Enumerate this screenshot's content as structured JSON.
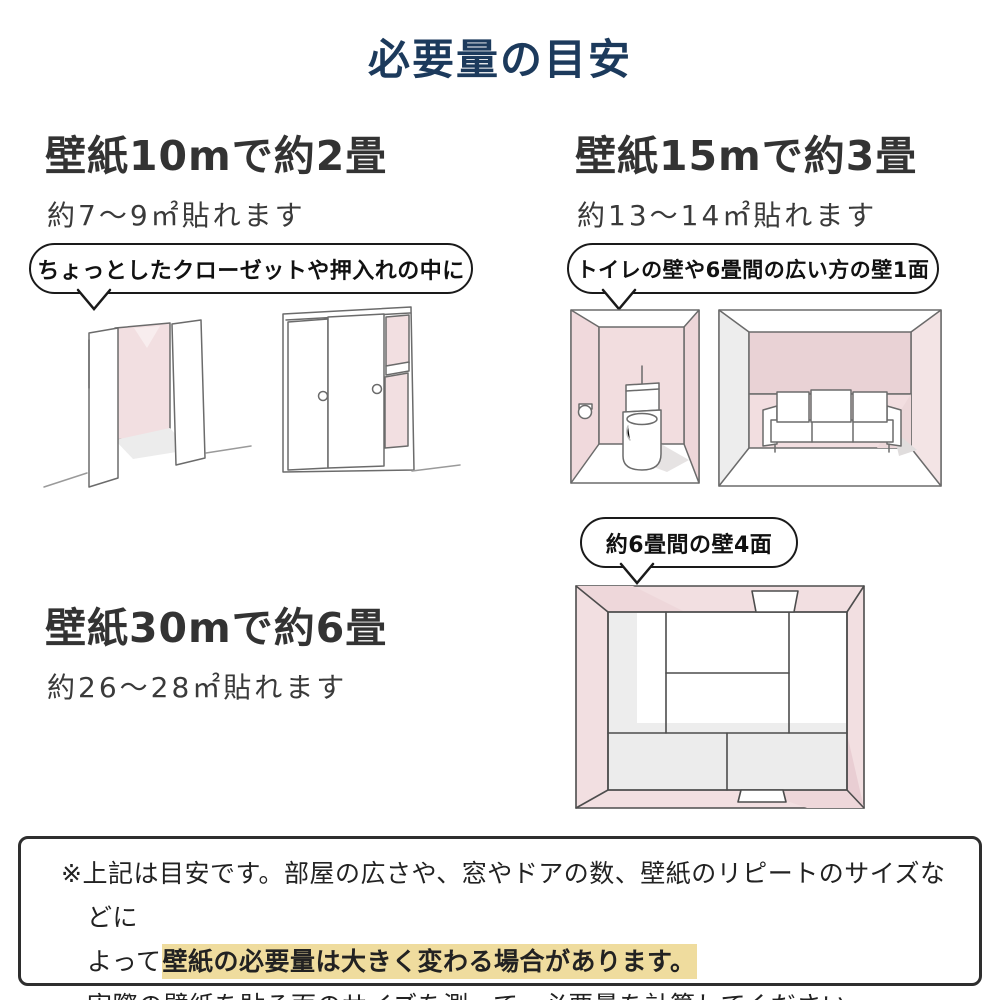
{
  "page": {
    "title": "必要量の目安"
  },
  "sections": [
    {
      "heading": "壁紙10mで約2畳",
      "subtext": "約7〜9㎡貼れます",
      "bubble": "ちょっとしたクローゼットや押入れの中に"
    },
    {
      "heading": "壁紙15mで約3畳",
      "subtext": "約13〜14㎡貼れます",
      "bubble": "トイレの壁や6畳間の広い方の壁1面"
    },
    {
      "heading": "壁紙30mで約6畳",
      "subtext": "約26〜28㎡貼れます",
      "bubble": "約6畳間の壁4面"
    }
  ],
  "note": {
    "line1": "※上記は目安です。部屋の広さや、窓やドアの数、壁紙のリピートのサイズなどに",
    "line2_prefix": "よって",
    "line2_highlight": "壁紙の必要量は大きく変わる場合があります。",
    "line3": "実際の壁紙を貼る面のサイズを測って、必要量を計算してください。"
  },
  "colors": {
    "title_navy": "#1c3a5c",
    "body_text": "#333333",
    "highlight_bg": "#efdc9e",
    "wallpaper_pink": "#f2dfe1"
  }
}
